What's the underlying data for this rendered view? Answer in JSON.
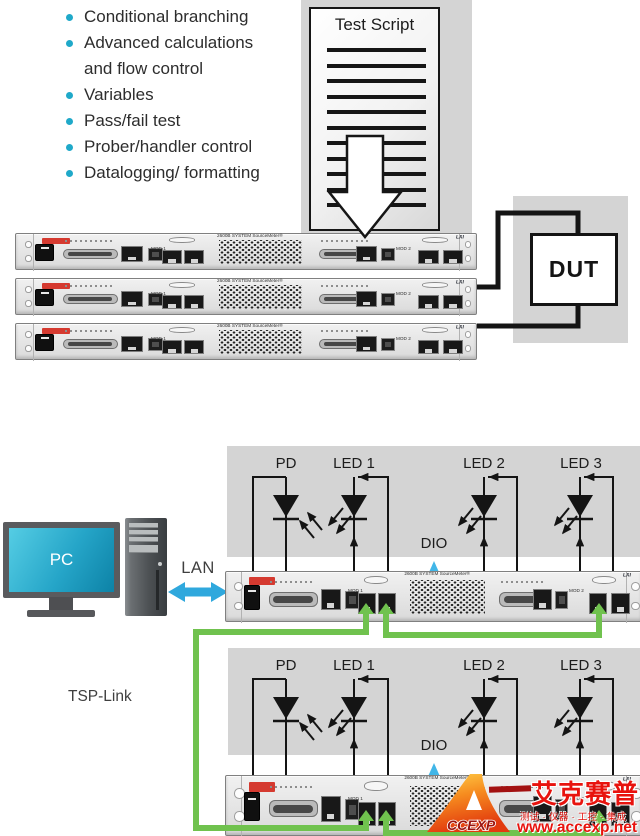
{
  "bullets": [
    "Conditional branching",
    "Advanced calculations and flow control",
    "Variables",
    "Pass/fail test",
    "Prober/handler control",
    "Datalogging/ formatting"
  ],
  "test_script": {
    "title": "Test Script"
  },
  "dut_label": "DUT",
  "pc_label": "PC",
  "lan_label": "LAN",
  "tsp_link_label": "TSP-Link",
  "dio_label": "DIO",
  "instrument": {
    "brand_label": "2600B SYSTEM SourceMeter®",
    "mod1_label": "MOD 1",
    "mod2_label": "MOD 2",
    "lxi_label": "LXI"
  },
  "circuit": {
    "pd_label": "PD",
    "led1_label": "LED 1",
    "led2_label": "LED 2",
    "led3_label": "LED 3"
  },
  "watermark": {
    "logo_text": "CCEXP",
    "brand_cn": "艾克赛普",
    "tagline": "测试 · 仪器 · 工控 · 集成",
    "url": "www.accexp.net"
  },
  "colors": {
    "bullet_teal": "#1fa9c9",
    "panel_gray": "#d4d4d4",
    "wire_green": "#70c24e",
    "lan_arrow_blue": "#2fa8dd",
    "dio_cyan": "#41b6e8",
    "watermark_red": "#e8130e",
    "wire_black": "#141414"
  }
}
